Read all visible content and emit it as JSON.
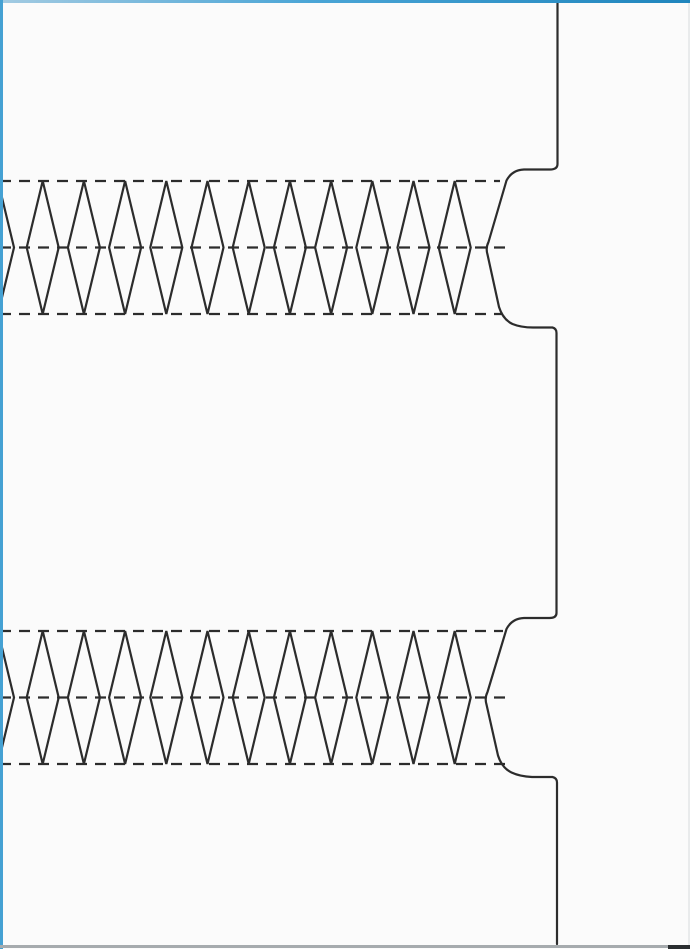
{
  "canvas": {
    "width": 690,
    "height": 949
  },
  "colors": {
    "paper": "#fbfbfb",
    "line": "#2c2c2c",
    "blue_left": "#45a1d3",
    "blue_top_start": "#a3cbe2",
    "blue_top_mid": "#4aa5d6",
    "blue_top_end": "#1f85bd",
    "bottom_gray": "#a6abae",
    "bottom_dark": "#2a2e30",
    "right_faint": "#c8ced2"
  },
  "pattern": {
    "line_width": 2.2,
    "dash": {
      "on": 11,
      "off": 8
    },
    "diamonds": {
      "count": 11,
      "first_center_x": 42.7,
      "pitch": 41.2,
      "half_width": 16,
      "edge_partial_center_x": -2
    },
    "bands": [
      {
        "top": 181,
        "middle": 247.5,
        "bottom": 314,
        "dash_end_top": 500,
        "dash_end_middle": 512,
        "dash_end_bottom": 502
      },
      {
        "top": 631,
        "middle": 697.5,
        "bottom": 764,
        "dash_end_top": 503,
        "dash_end_middle": 510,
        "dash_end_bottom": 505
      }
    ],
    "right_edge_path": "M 557.5 3 L 557.5 164 Q 557.5 169.5 550 169.5 L 524 169.5 Q 512 170 506.5 180.5 L 488.5 242 Q 485.5 248 487.5 254.5 L 499 307 Q 503 319.5 512.5 324 Q 521 327.5 533 327.5 L 552.5 327.5 Q 556.5 328.5 556.5 333 L 556.5 613 Q 556.5 618 549.5 618 L 524 618 Q 512 618.5 506.5 629 L 487.5 692 Q 484.5 698 486.5 704.5 L 498 755.5 Q 502 768 511.5 772.5 Q 520 776.5 532 777 L 552.5 777 Q 557 778 557 782.5 L 557 944"
  }
}
